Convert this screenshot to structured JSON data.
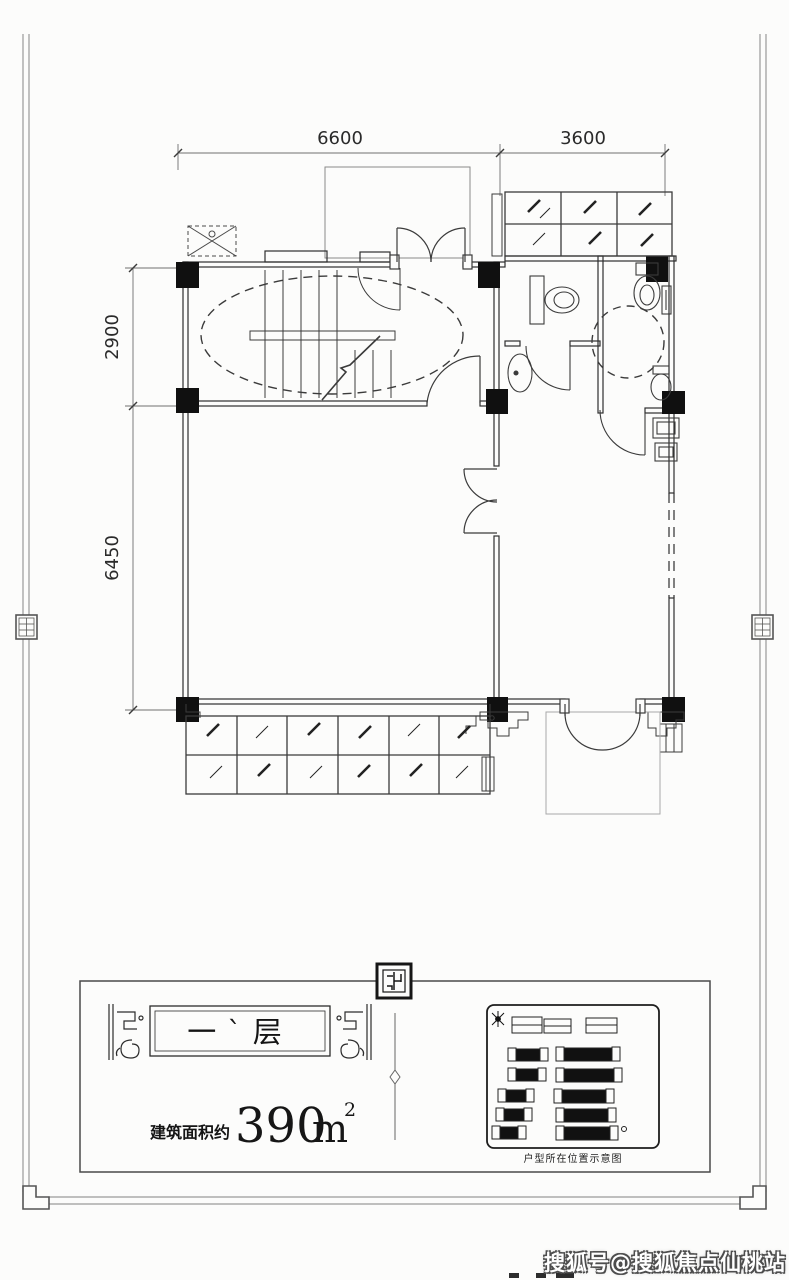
{
  "page": {
    "watermark": "搜狐号@搜狐焦点仙桃站"
  },
  "dimensions": {
    "top": [
      "6600",
      "3600"
    ],
    "left": [
      "2900",
      "6450"
    ]
  },
  "title_block": {
    "floor_label": "一`层",
    "area_prefix": "建筑面积约",
    "area_value": "390",
    "area_unit": "m",
    "area_exponent": "2",
    "legend_caption": "户型所在位置示意图"
  },
  "colors": {
    "line": "#3b3b3b",
    "wall": "#2e2e2e",
    "column_fill": "#101010",
    "dim": "#6f6f6f",
    "watermark_fill": "#ffffff",
    "watermark_outline": "#4d4d4d"
  }
}
